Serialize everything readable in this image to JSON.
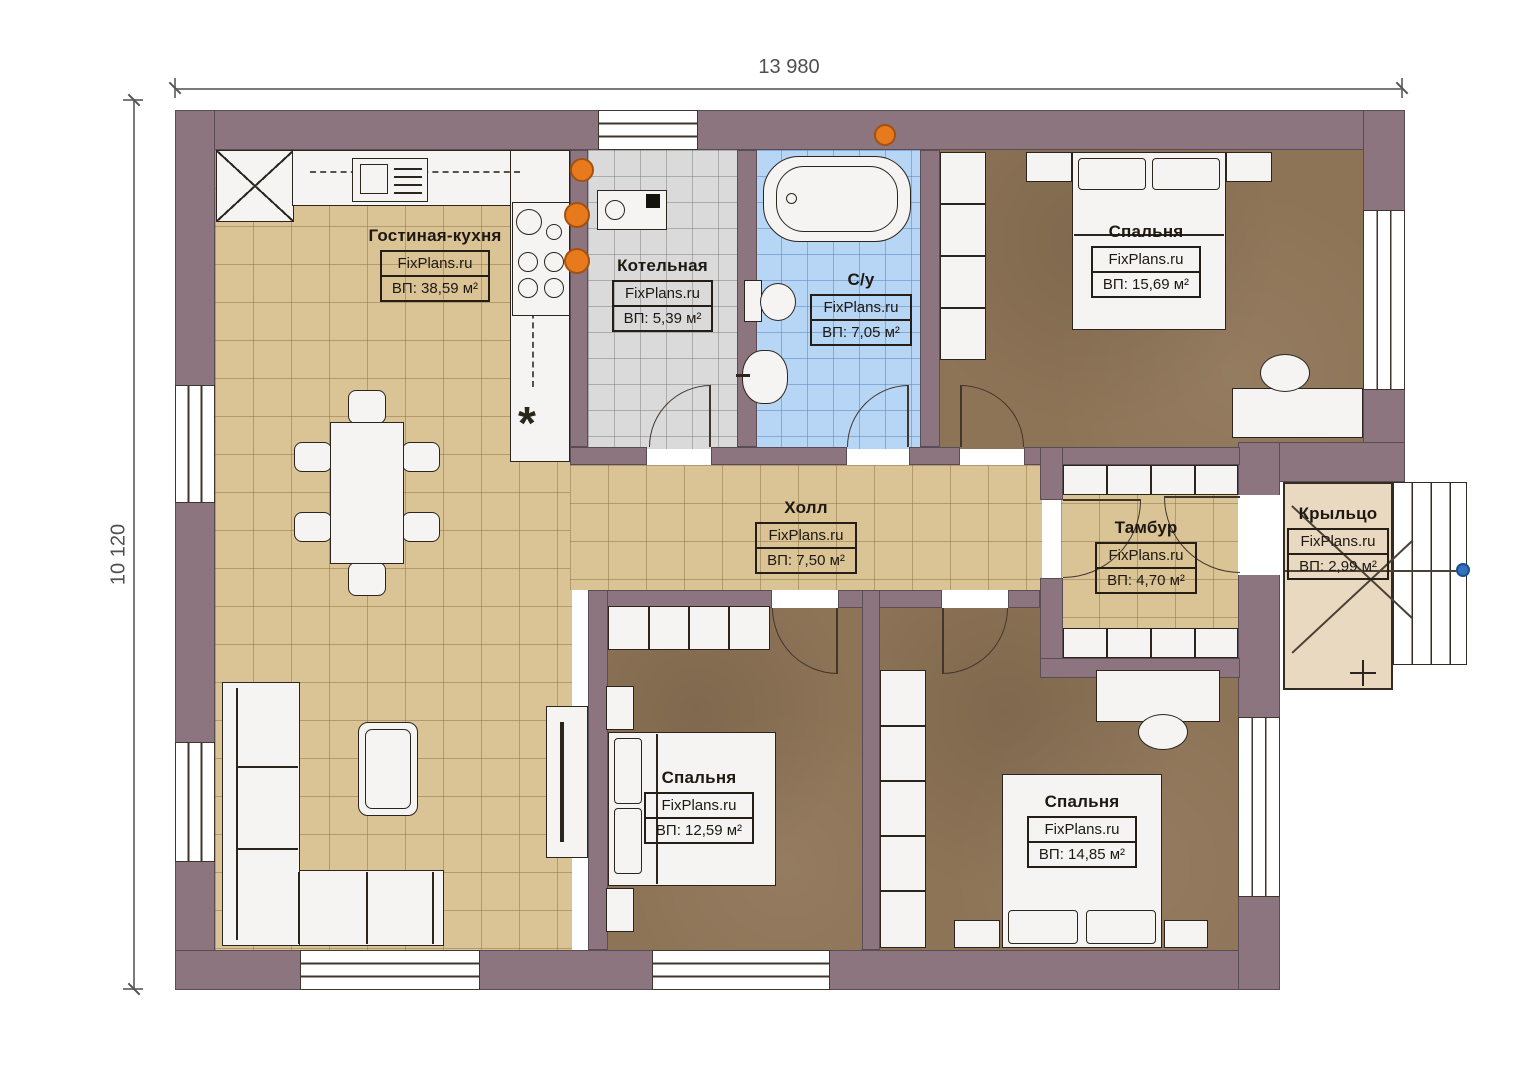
{
  "brand": "FixPlans.ru",
  "dimensions": {
    "width": "13 980",
    "height": "10 120"
  },
  "rooms": {
    "living": {
      "name": "Гостиная-кухня",
      "brand": "FixPlans.ru",
      "area": "ВП: 38,59 м²"
    },
    "boiler": {
      "name": "Котельная",
      "brand": "FixPlans.ru",
      "area": "ВП: 5,39 м²"
    },
    "bathroom": {
      "name": "С/у",
      "brand": "FixPlans.ru",
      "area": "ВП: 7,05 м²"
    },
    "bedroom_top": {
      "name": "Спальня",
      "brand": "FixPlans.ru",
      "area": "ВП: 15,69 м²"
    },
    "hall": {
      "name": "Холл",
      "brand": "FixPlans.ru",
      "area": "ВП: 7,50 м²"
    },
    "tambour": {
      "name": "Тамбур",
      "brand": "FixPlans.ru",
      "area": "ВП: 4,70 м²"
    },
    "porch": {
      "name": "Крыльцо",
      "brand": "FixPlans.ru",
      "area": "ВП: 2,99 м²"
    },
    "bedroom_mid": {
      "name": "Спальня",
      "brand": "FixPlans.ru",
      "area": "ВП: 12,59 м²"
    },
    "bedroom_right": {
      "name": "Спальня",
      "brand": "FixPlans.ru",
      "area": "ВП: 14,85 м²"
    }
  },
  "symbols": {
    "kitchen_asterisk": "*"
  },
  "colors": {
    "wall": "#8d7580",
    "floor_tan": "#dac395",
    "floor_gray": "#dadada",
    "floor_blue": "#b7d5f5",
    "floor_brown": "#8e7457",
    "floor_porch": "#ead9c1",
    "radiator_orange": "#e87a1e",
    "handle_blue": "#3273c0"
  }
}
